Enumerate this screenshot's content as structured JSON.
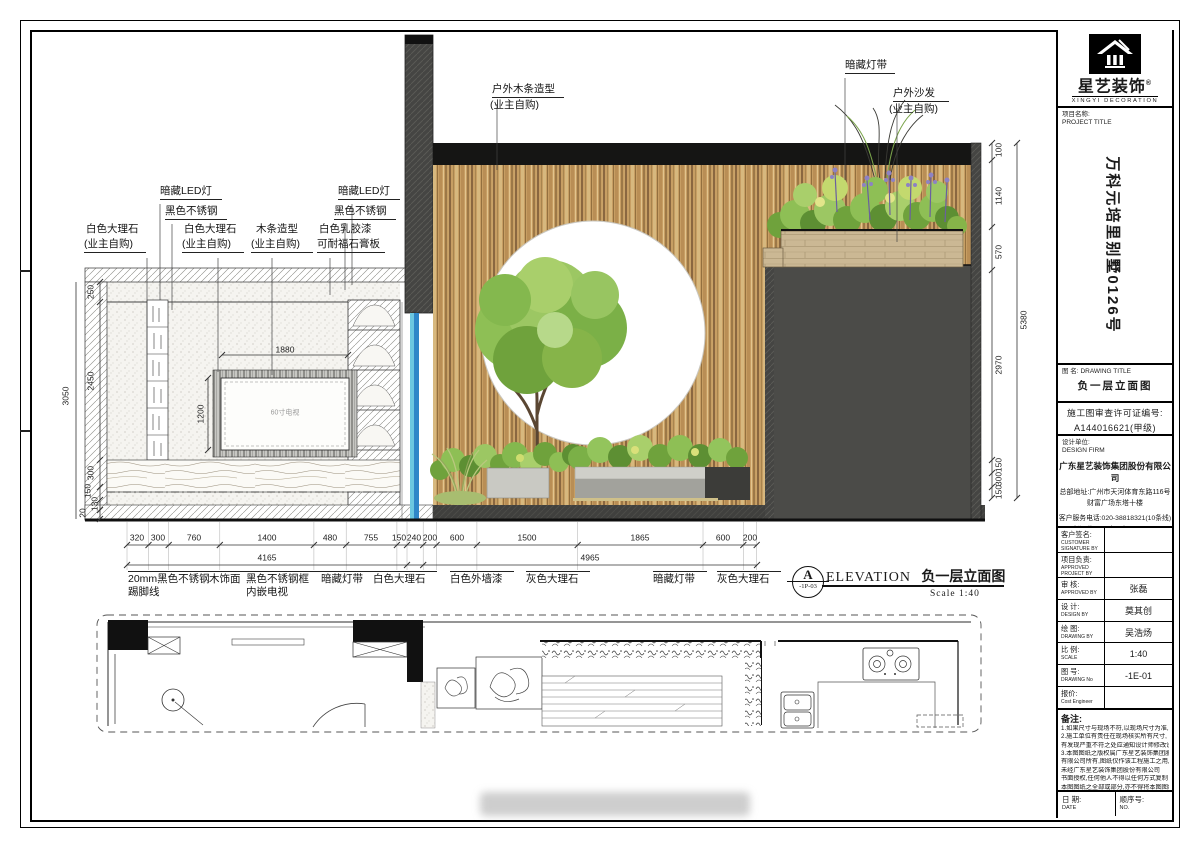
{
  "titleblock": {
    "brand": "星艺装饰",
    "brand_reg": "®",
    "brand_en": "XINGYI DECORATION",
    "project_label": "项目名称:",
    "project_label_en": "PROJECT TITLE",
    "project_name": "万科元培里别墅0126号",
    "drawing_label": "图 名:",
    "drawing_label_en": "DRAWING TITLE",
    "drawing_title": "负一层立面图",
    "permit_line1": "施工图审查许可证编号:",
    "permit_line2": "A144016621(甲级)",
    "firm_label": "设计单位:",
    "firm_label_en": "DESIGN FIRM",
    "firm_name": "广东星艺装饰集团股份有限公司",
    "firm_addr1": "总部地址:广州市天河体育东路116号",
    "firm_addr2": "财富广场东塔十楼",
    "firm_tel": "客户服务电话:020-38818321(10条线)",
    "firm_url": "http://www.xingyigz.com.cn",
    "rows": [
      {
        "label": "客户签名:",
        "label_en": "CUSTOMER SIGNATURE BY",
        "value": ""
      },
      {
        "label": "项目负责:",
        "label_en": "APPROVED PROJECT BY",
        "value": ""
      },
      {
        "label": "审 核:",
        "label_en": "APPROVED BY",
        "value": "张磊"
      },
      {
        "label": "设 计:",
        "label_en": "DESIGN BY",
        "value": "莫其创"
      },
      {
        "label": "绘 图:",
        "label_en": "DRAWING BY",
        "value": "吴浩炀"
      },
      {
        "label": "比 例:",
        "label_en": "SCALE",
        "value": "1:40"
      },
      {
        "label": "图 号:",
        "label_en": "DRAWING No",
        "value": "-1E-01"
      },
      {
        "label": "报价:",
        "label_en": "Cost Engineer",
        "value": ""
      }
    ],
    "notes_label": "备注:",
    "notes": [
      "1.如果尺寸与现场不符,以现场尺寸为准,",
      "2.施工单位有责任在现场核实所有尺寸,",
      "有发现严重不符之处应通知设计师修改设计",
      "3.本图图纸之版权属广东星艺装饰集团股份",
      "有限公司所有,图纸仅作该工程施工之用,",
      "未经广东星艺装饰集团股份有限公司",
      "书面授权,任何他人不得以任何方式复制",
      "本图图纸之全部或部分,亦不得将本图图纸",
      "用于其他任何用途."
    ],
    "date_label": "日 期:",
    "date_label_en": "DATE",
    "no_label": "顺序号:",
    "no_label_en": "NO."
  },
  "elevation": {
    "marker_letter": "A",
    "marker_ref": "-1P-03",
    "title_en": "ELEVATION",
    "title_cn": "负一层立面图",
    "scale": "Scale 1:40"
  },
  "annotations": [
    {
      "t": "户外木条造型",
      "x": 492,
      "y": 84,
      "w": 72,
      "u": 1,
      "cls": "c"
    },
    {
      "t": "(业主自购)",
      "x": 490,
      "y": 100,
      "cls": "c"
    },
    {
      "t": "暗藏灯带",
      "x": 845,
      "y": 60,
      "w": 50,
      "u": 1,
      "cls": "c"
    },
    {
      "t": "户外沙发",
      "x": 893,
      "y": 88,
      "w": 56,
      "u": 1,
      "cls": "c"
    },
    {
      "t": "(业主自购)",
      "x": 889,
      "y": 104,
      "cls": "c"
    },
    {
      "t": "暗藏LED灯",
      "x": 160,
      "y": 186,
      "w": 62,
      "u": 1,
      "cls": "c"
    },
    {
      "t": "黑色不锈钢",
      "x": 165,
      "y": 206,
      "w": 62,
      "u": 1,
      "cls": "c"
    },
    {
      "t": "白色大理石",
      "x": 86,
      "y": 224,
      "cls": "c"
    },
    {
      "t": "(业主自购)",
      "x": 84,
      "y": 239,
      "w": 62,
      "u": 1,
      "cls": "c"
    },
    {
      "t": "白色大理石",
      "x": 184,
      "y": 224,
      "cls": "c"
    },
    {
      "t": "(业主自购)",
      "x": 182,
      "y": 239,
      "w": 62,
      "u": 1,
      "cls": "c"
    },
    {
      "t": "木条造型",
      "x": 256,
      "y": 224,
      "cls": "c"
    },
    {
      "t": "(业主自购)",
      "x": 251,
      "y": 239,
      "w": 62,
      "u": 1,
      "cls": "c"
    },
    {
      "t": "白色乳胶漆",
      "x": 319,
      "y": 224,
      "cls": "c"
    },
    {
      "t": "可耐福石膏板",
      "x": 317,
      "y": 239,
      "w": 68,
      "u": 1,
      "cls": "c"
    },
    {
      "t": "暗藏LED灯",
      "x": 338,
      "y": 186,
      "w": 62,
      "u": 1,
      "cls": "c"
    },
    {
      "t": "黑色不锈钢",
      "x": 334,
      "y": 206,
      "w": 62,
      "u": 1,
      "cls": "c"
    },
    {
      "t": "20mm黑色不锈钢",
      "x": 128,
      "y": 571,
      "w": 95,
      "cls": "m"
    },
    {
      "t": "踢脚线",
      "x": 128,
      "y": 587,
      "cls": "c"
    },
    {
      "t": "木饰面",
      "x": 209,
      "y": 571,
      "w": 42,
      "cls": "m"
    },
    {
      "t": "黑色不锈钢框",
      "x": 246,
      "y": 571,
      "w": 78,
      "cls": "m"
    },
    {
      "t": "内嵌电视",
      "x": 246,
      "y": 587,
      "cls": "c"
    },
    {
      "t": "暗藏灯带",
      "x": 321,
      "y": 571,
      "w": 54,
      "cls": "m"
    },
    {
      "t": "白色大理石",
      "x": 373,
      "y": 571,
      "w": 64,
      "cls": "m"
    },
    {
      "t": "白色外墙漆",
      "x": 450,
      "y": 571,
      "w": 64,
      "cls": "m"
    },
    {
      "t": "灰色大理石",
      "x": 526,
      "y": 571,
      "w": 64,
      "cls": "m"
    },
    {
      "t": "暗藏灯带",
      "x": 653,
      "y": 571,
      "w": 54,
      "cls": "m"
    },
    {
      "t": "灰色大理石",
      "x": 717,
      "y": 571,
      "w": 64,
      "cls": "m"
    },
    {
      "t": "320",
      "x": 137,
      "y": 538,
      "cls": "d"
    },
    {
      "t": "300",
      "x": 158,
      "y": 538,
      "cls": "d"
    },
    {
      "t": "760",
      "x": 194,
      "y": 538,
      "cls": "d"
    },
    {
      "t": "1400",
      "x": 267,
      "y": 538,
      "cls": "d"
    },
    {
      "t": "480",
      "x": 330,
      "y": 538,
      "cls": "d"
    },
    {
      "t": "755",
      "x": 371,
      "y": 538,
      "cls": "d"
    },
    {
      "t": "150",
      "x": 399,
      "y": 538,
      "cls": "d"
    },
    {
      "t": "240",
      "x": 414,
      "y": 538,
      "cls": "d"
    },
    {
      "t": "200",
      "x": 430,
      "y": 538,
      "cls": "d"
    },
    {
      "t": "600",
      "x": 457,
      "y": 538,
      "cls": "d"
    },
    {
      "t": "1500",
      "x": 527,
      "y": 538,
      "cls": "d"
    },
    {
      "t": "1865",
      "x": 640,
      "y": 538,
      "cls": "d"
    },
    {
      "t": "600",
      "x": 723,
      "y": 538,
      "cls": "d"
    },
    {
      "t": "200",
      "x": 750,
      "y": 538,
      "cls": "d"
    },
    {
      "t": "4165",
      "x": 267,
      "y": 558,
      "cls": "d"
    },
    {
      "t": "4965",
      "x": 590,
      "y": 558,
      "cls": "d"
    },
    {
      "t": "1880",
      "x": 285,
      "y": 350,
      "cls": "d"
    },
    {
      "t": "1200",
      "x": 201,
      "y": 414,
      "cls": "dr"
    },
    {
      "t": "250",
      "x": 91,
      "y": 292,
      "cls": "dr"
    },
    {
      "t": "2450",
      "x": 91,
      "y": 381,
      "cls": "dr"
    },
    {
      "t": "300",
      "x": 91,
      "y": 473,
      "cls": "dr"
    },
    {
      "t": "150",
      "x": 88,
      "y": 491,
      "cls": "dr"
    },
    {
      "t": "130",
      "x": 95,
      "y": 504,
      "cls": "dr"
    },
    {
      "t": "20",
      "x": 83,
      "y": 513,
      "cls": "dr"
    },
    {
      "t": "3050",
      "x": 66,
      "y": 396,
      "cls": "dr"
    },
    {
      "t": "100",
      "x": 999,
      "y": 150,
      "cls": "dr"
    },
    {
      "t": "1140",
      "x": 999,
      "y": 196,
      "cls": "dr"
    },
    {
      "t": "570",
      "x": 999,
      "y": 252,
      "cls": "dr"
    },
    {
      "t": "2970",
      "x": 999,
      "y": 365,
      "cls": "dr"
    },
    {
      "t": "150",
      "x": 999,
      "y": 465,
      "cls": "dr"
    },
    {
      "t": "300",
      "x": 999,
      "y": 479,
      "cls": "dr"
    },
    {
      "t": "150",
      "x": 999,
      "y": 492,
      "cls": "dr"
    },
    {
      "t": "5380",
      "x": 1024,
      "y": 320,
      "cls": "dr"
    },
    {
      "t": "60寸电视",
      "x": 285,
      "y": 413,
      "cls": "tv"
    }
  ],
  "colors": {
    "wood_slat": "#c79e63",
    "dark_wall": "#4b4b48",
    "beam_black": "#151514",
    "glass_blue": "#3fa9d5",
    "tree_green": "#8ebf55",
    "flower_purple": "#6a5fa0",
    "concrete": "#c9c9c3"
  }
}
